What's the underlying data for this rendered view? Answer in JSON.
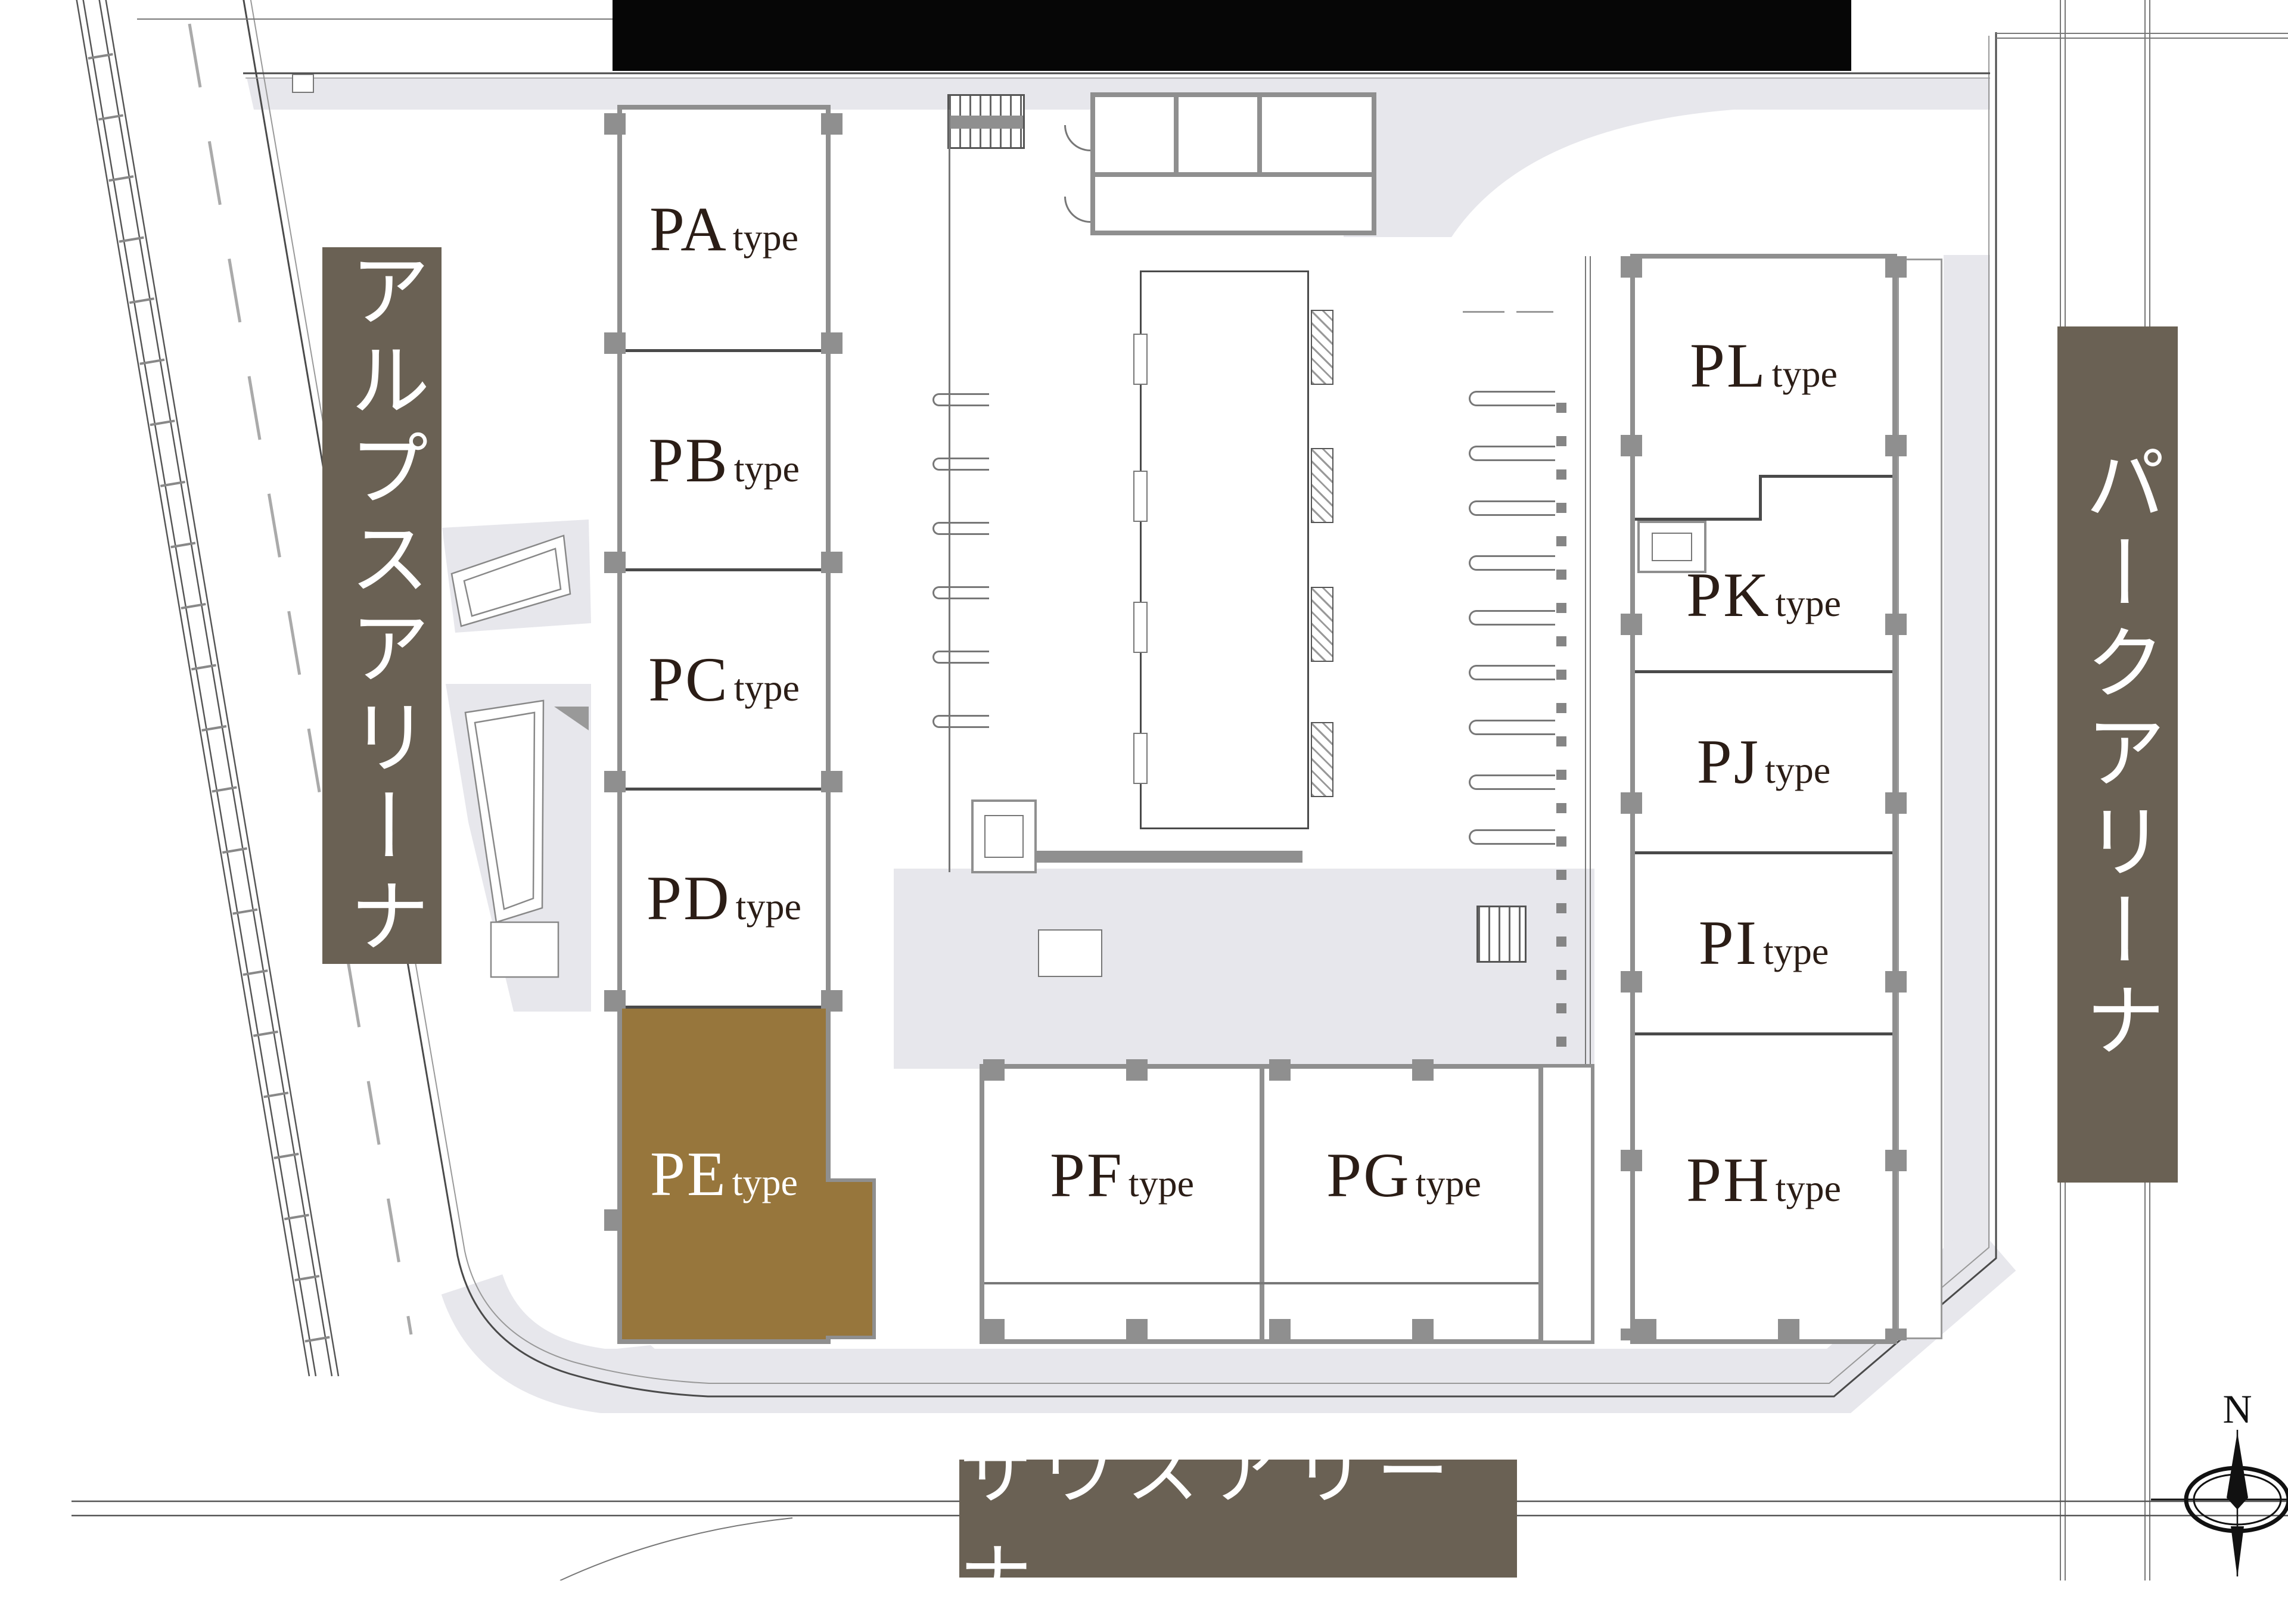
{
  "title": "site-plan",
  "arenas": {
    "west": {
      "label": "アルプスアリーナ"
    },
    "east": {
      "label": "パークアリーナ"
    },
    "south": {
      "label": "サウスアリーナ"
    }
  },
  "compass": {
    "label": "N"
  },
  "units": [
    {
      "code": "PA",
      "suffix": "type",
      "highlighted": false
    },
    {
      "code": "PB",
      "suffix": "type",
      "highlighted": false
    },
    {
      "code": "PC",
      "suffix": "type",
      "highlighted": false
    },
    {
      "code": "PD",
      "suffix": "type",
      "highlighted": false
    },
    {
      "code": "PE",
      "suffix": "type",
      "highlighted": true
    },
    {
      "code": "PF",
      "suffix": "type",
      "highlighted": false
    },
    {
      "code": "PG",
      "suffix": "type",
      "highlighted": false
    },
    {
      "code": "PH",
      "suffix": "type",
      "highlighted": false
    },
    {
      "code": "PI",
      "suffix": "type",
      "highlighted": false
    },
    {
      "code": "PJ",
      "suffix": "type",
      "highlighted": false
    },
    {
      "code": "PK",
      "susuffix_note": "",
      "suffix": "type",
      "highlighted": false
    },
    {
      "code": "PL",
      "suffix": "type",
      "highlighted": false
    }
  ],
  "colors": {
    "highlight": "#97763C",
    "band": "#6A6154",
    "wall": "#8F8F8F",
    "ink": "#2B1D16",
    "paving": "#E7E7EC",
    "line": "#4A4A4A"
  }
}
